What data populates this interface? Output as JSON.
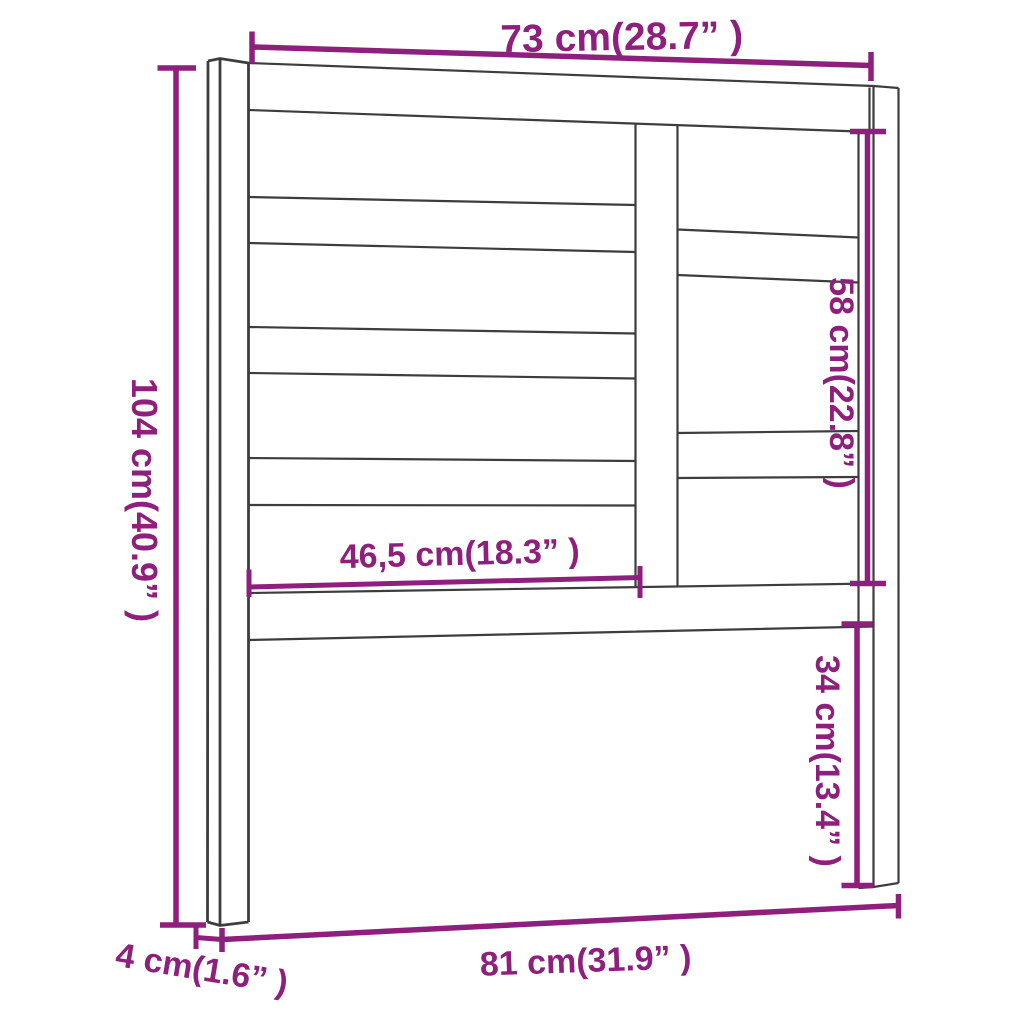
{
  "figure": {
    "subject": "bed-headboard-technical-line-drawing",
    "background_color": "#ffffff",
    "outline_color": "#3d3d3d",
    "dimension_color": "#8e1f7d",
    "dimensions": {
      "top_width": "73 cm(28.7” )",
      "left_height": "104 cm(40.9” )",
      "inner_width": "46,5 cm(18.3” )",
      "right_section_height": "58 cm(22.8” )",
      "leg_height": "34 cm(13.4” )",
      "bottom_width": "81 cm(31.9” )",
      "depth": "4 cm(1.6” )"
    }
  }
}
